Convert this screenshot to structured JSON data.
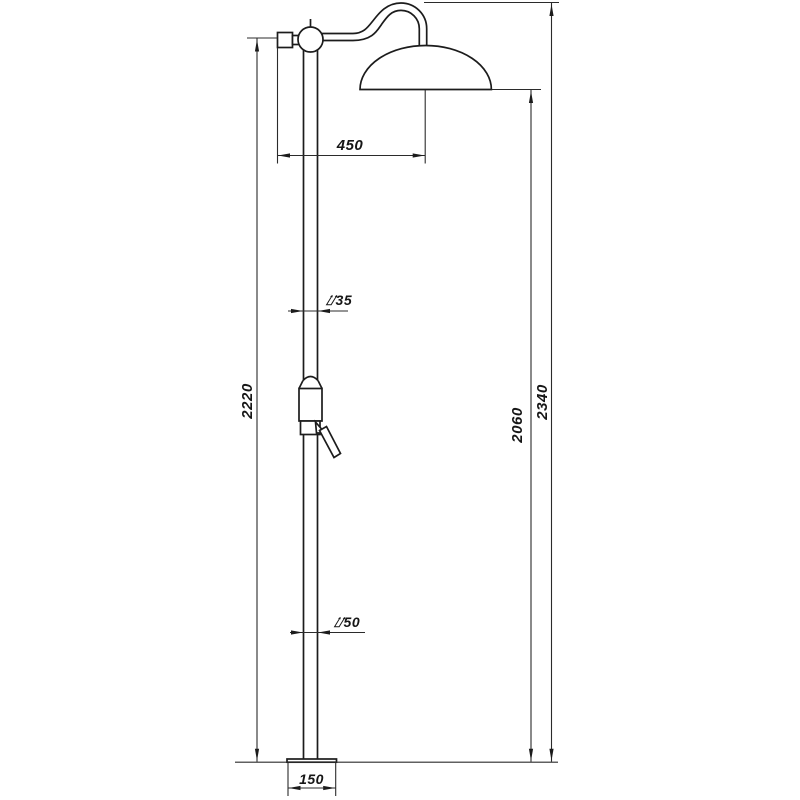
{
  "colors": {
    "line": "#1c1c1c",
    "dimension_line": "#2b2b2b",
    "background": "#ffffff"
  },
  "drawing": {
    "dimension_labels": {
      "arm_reach": "450",
      "upper_pipe_diameter": "⌰35",
      "lower_pipe_diameter": "⌰50",
      "column_height": "2220",
      "head_rim_height": "2060",
      "overall_height": "2340",
      "base_width": "150"
    }
  }
}
